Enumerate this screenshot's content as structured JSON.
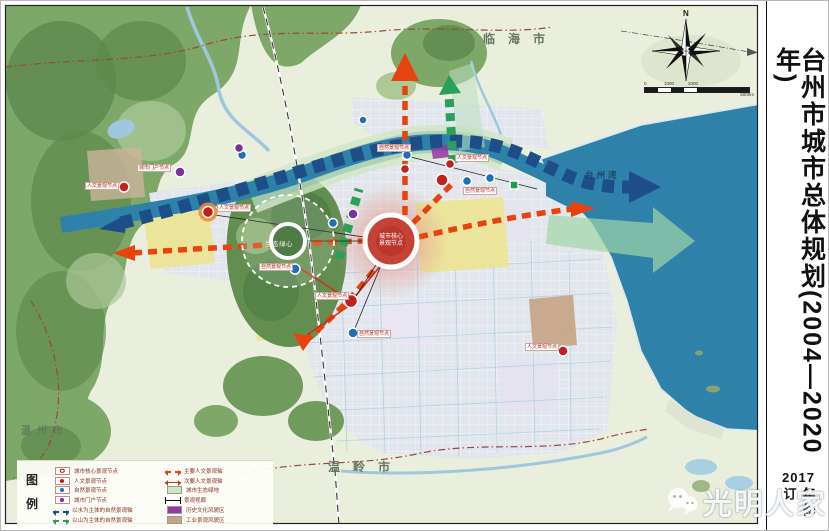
{
  "title_panel": {
    "title": "台州市城市总体规划(2004—2020年)",
    "revision_year": "2017",
    "revision_note": "年修订"
  },
  "map": {
    "region_labels": {
      "north_city": "临海市",
      "south_city": "温岭市",
      "west_city": "温州市",
      "bay": "台州湾"
    },
    "core_label": [
      "城市核心",
      "景观节点"
    ],
    "green_heart_label": "生态绿心",
    "node_labels": [
      "城市门户节点",
      "人文景观节点",
      "人文景观节点",
      "自然景观节点",
      "人文景观节点",
      "自然景观节点",
      "自然景观节点",
      "人文景观节点",
      "人文景观节点",
      "自然景观节点"
    ],
    "compass": {
      "label": "N"
    },
    "scale": {
      "tick0": "0",
      "tick1": "1000",
      "tick2": "2000",
      "tick3": "5000m"
    }
  },
  "legend": {
    "heading": [
      "图",
      "例"
    ],
    "items_left": [
      "城市核心景观节点",
      "人文景观节点",
      "自然景观节点",
      "城市门户节点",
      "以水为主体的自然景观轴",
      "以山为主体的自然景观轴"
    ],
    "items_right": [
      "主要人文景观轴",
      "次要人文景观轴",
      "城市生态绿地",
      "景观视廊",
      "历史文化风貌区",
      "工业景观风貌区"
    ]
  },
  "watermark": {
    "text": "光明人家",
    "icon": "wechat-icon"
  },
  "colors": {
    "sea": "#2e81a8",
    "water_axis_blue": "#1d4e87",
    "main_axis_red": "#e8420e",
    "mountain_green": "#6f9f5e",
    "eco_green": "#cfe6c4",
    "history_purple": "#9a35a8",
    "industry_brown": "#c8a384",
    "node_red": "#c41f1f",
    "node_blue": "#1f6fb5",
    "node_purple": "#7b2fa0",
    "highlight_yellow": "#ece492",
    "core_red": "#c64236"
  }
}
